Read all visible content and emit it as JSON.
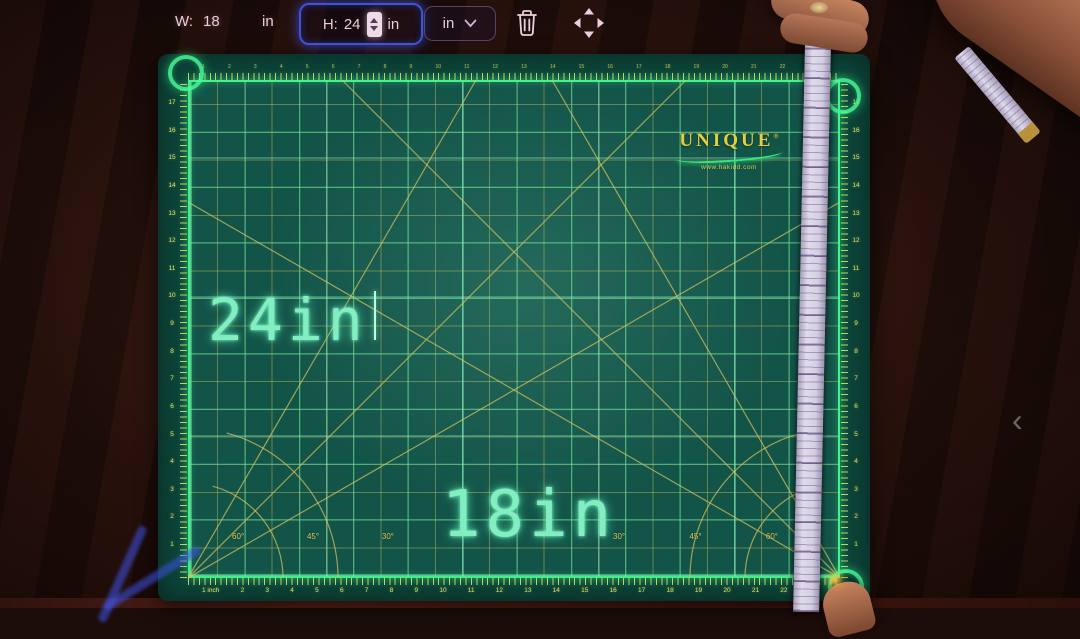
{
  "toolbar": {
    "width_field": {
      "label": "W:",
      "value": "18",
      "unit": "in"
    },
    "height_field": {
      "label": "H:",
      "value": "24",
      "unit": "in"
    },
    "unit_dropdown": {
      "value": "in"
    }
  },
  "projection": {
    "height_label": "24in",
    "width_label": "18in"
  },
  "mat": {
    "brand": "UNIQUE",
    "brand_mark": "®",
    "website": "www.hakidd.com",
    "ruler_top": [
      "1",
      "2",
      "3",
      "4",
      "5",
      "6",
      "7",
      "8",
      "9",
      "10",
      "11",
      "12",
      "13",
      "14",
      "15",
      "16",
      "17",
      "18",
      "19",
      "20",
      "21",
      "22",
      "23"
    ],
    "ruler_bottom": [
      "1 inch",
      "2",
      "3",
      "4",
      "5",
      "6",
      "7",
      "8",
      "9",
      "10",
      "11",
      "12",
      "13",
      "14",
      "15",
      "16",
      "17",
      "18",
      "19",
      "20",
      "21",
      "22",
      "23"
    ],
    "ruler_left": [
      "17",
      "16",
      "15",
      "14",
      "13",
      "12",
      "11",
      "10",
      "9",
      "8",
      "7",
      "6",
      "5",
      "4",
      "3",
      "2",
      "1"
    ],
    "ruler_right": [
      "17",
      "16",
      "15",
      "14",
      "13",
      "12",
      "11",
      "10",
      "9",
      "8",
      "7",
      "6",
      "5",
      "4",
      "3",
      "2",
      "1"
    ],
    "angle_labels_left": [
      "60°",
      "45°",
      "30°"
    ],
    "angle_labels_right": [
      "30°",
      "45°",
      "60°"
    ]
  },
  "side_panel": {
    "collapse_glyph": "‹"
  },
  "colors": {
    "accent_green": "#3df07e",
    "grid_yellow": "#d6c058",
    "mat_surface": "#135449",
    "selection_blue": "#3c55d8"
  }
}
